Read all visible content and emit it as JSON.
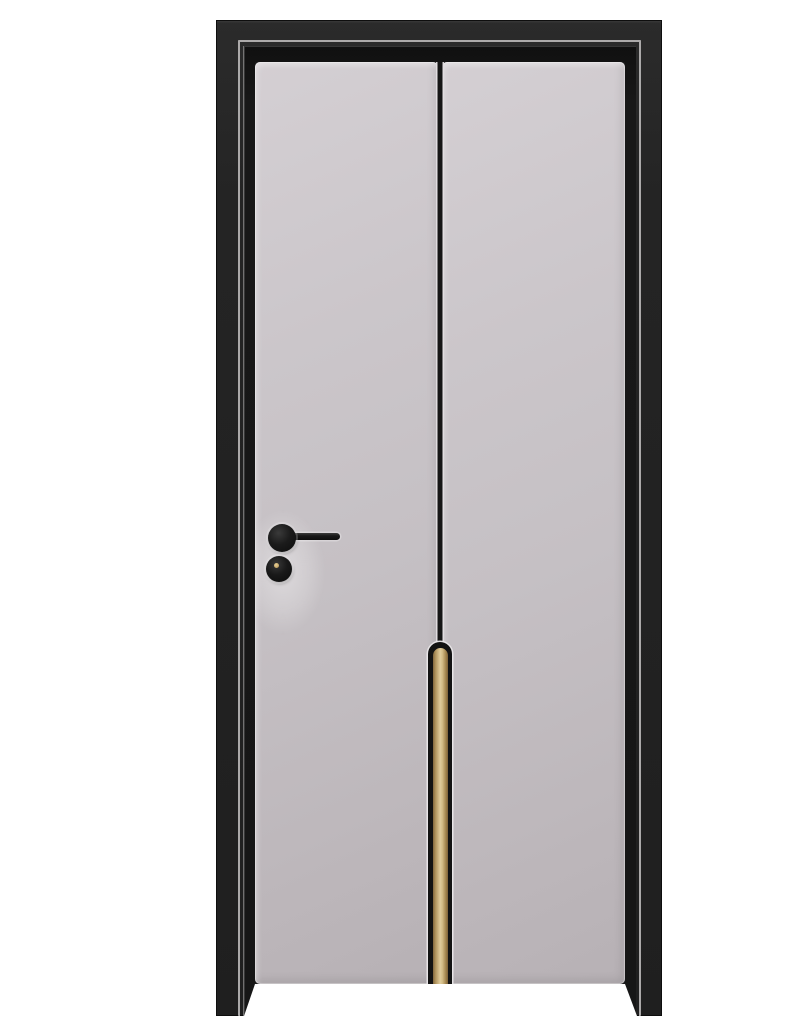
{
  "meta": {
    "alt": "Light grey interior door mounted in a matte black frame with a thin silver accent line; the door has two flat panels split by a vertical black groove that ends in a brass inlay strip, plus a black lever handle and a round cylinder lock with a brass keyhole"
  },
  "scene": {
    "background_color": "#ffffff"
  },
  "frame": {
    "label": "black-door-frame",
    "color": "#242424",
    "accent_line_color": "#b3b1b1",
    "jamb_color": "#161616"
  },
  "door": {
    "label": "grey-door-slab",
    "face_color": "#c5c0c4",
    "panel_count": 2,
    "groove_color": "#161616",
    "inlay": {
      "label": "brass-inlay-strip",
      "gold_light": "#e0cc9c",
      "gold_mid": "#b2955f",
      "gold_dark": "#7d6239",
      "border_color": "#131313",
      "highlight_color": "#eae7e9"
    }
  },
  "hardware": {
    "handle": {
      "label": "black-lever-handle",
      "color": "#161616"
    },
    "lock": {
      "label": "round-cylinder-lock",
      "color": "#141414",
      "keyhole_color": "#c8a765"
    }
  }
}
